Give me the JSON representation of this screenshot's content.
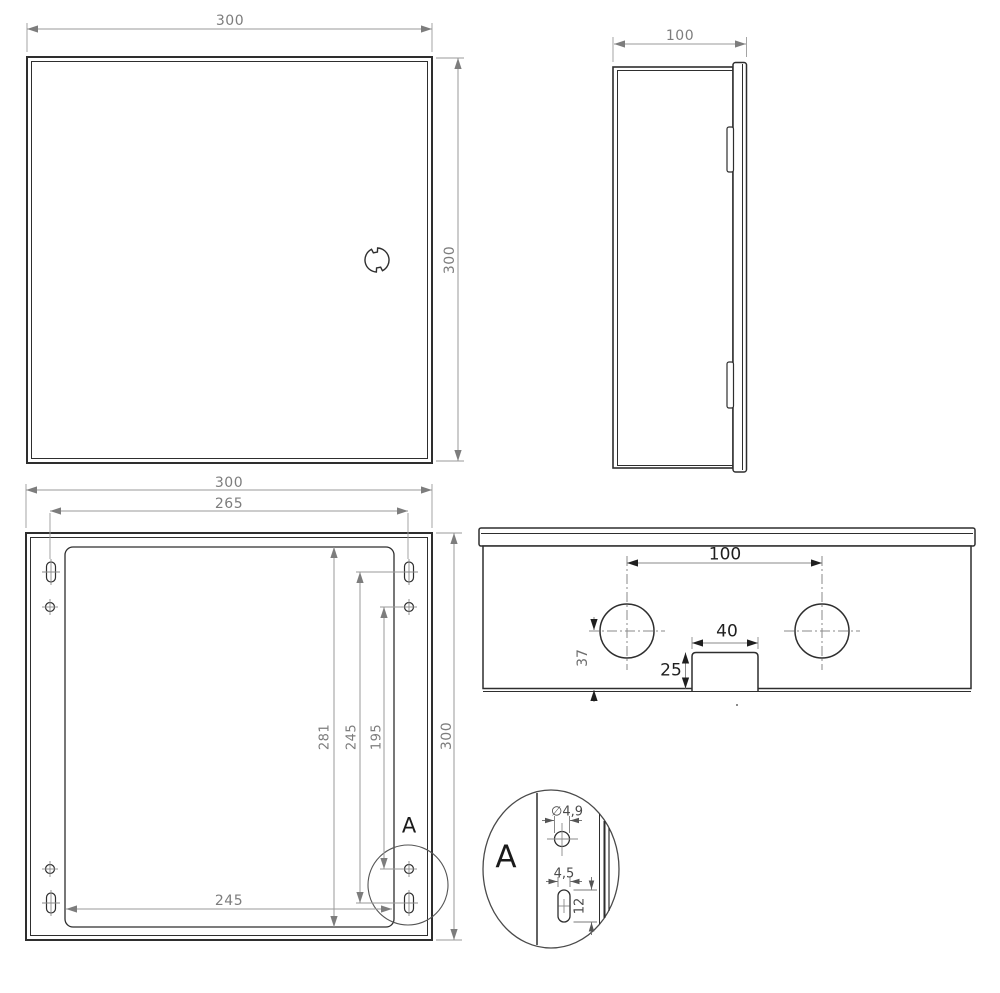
{
  "page": {
    "background": "#ffffff",
    "description": "technical drawing of metal enclosure, four orthographic views plus detail"
  },
  "views": {
    "front": {
      "name": "front view",
      "dim_width": "300",
      "dim_height": "300"
    },
    "side": {
      "name": "side view",
      "dim_depth": "100"
    },
    "back": {
      "name": "back view with mounting holes",
      "dim_width": "300",
      "dim_slot_spacing_h": "265",
      "dim_inner_height": "281",
      "dim_slot_spacing_v": "245",
      "dim_hole_spacing_v": "195",
      "dim_height": "300",
      "dim_inner_width": "245",
      "detail_marker": "A"
    },
    "top": {
      "name": "top view with cable glands",
      "dim_gland_spacing": "100",
      "dim_notch_width": "40",
      "dim_notch_depth": "25",
      "dim_gland_offset": "37"
    },
    "detail": {
      "name": "detail A",
      "label": "A",
      "dim_hole_diameter": "∅4,9",
      "dim_slot_width": "4,5",
      "dim_slot_length": "12"
    }
  },
  "colors": {
    "geometry": "#2e2e2e",
    "dimension_line": "#9a9a9a",
    "dimension_text": "#7d7d7d",
    "dimension_text_dark": "#1f1f1f",
    "background": "#ffffff"
  }
}
